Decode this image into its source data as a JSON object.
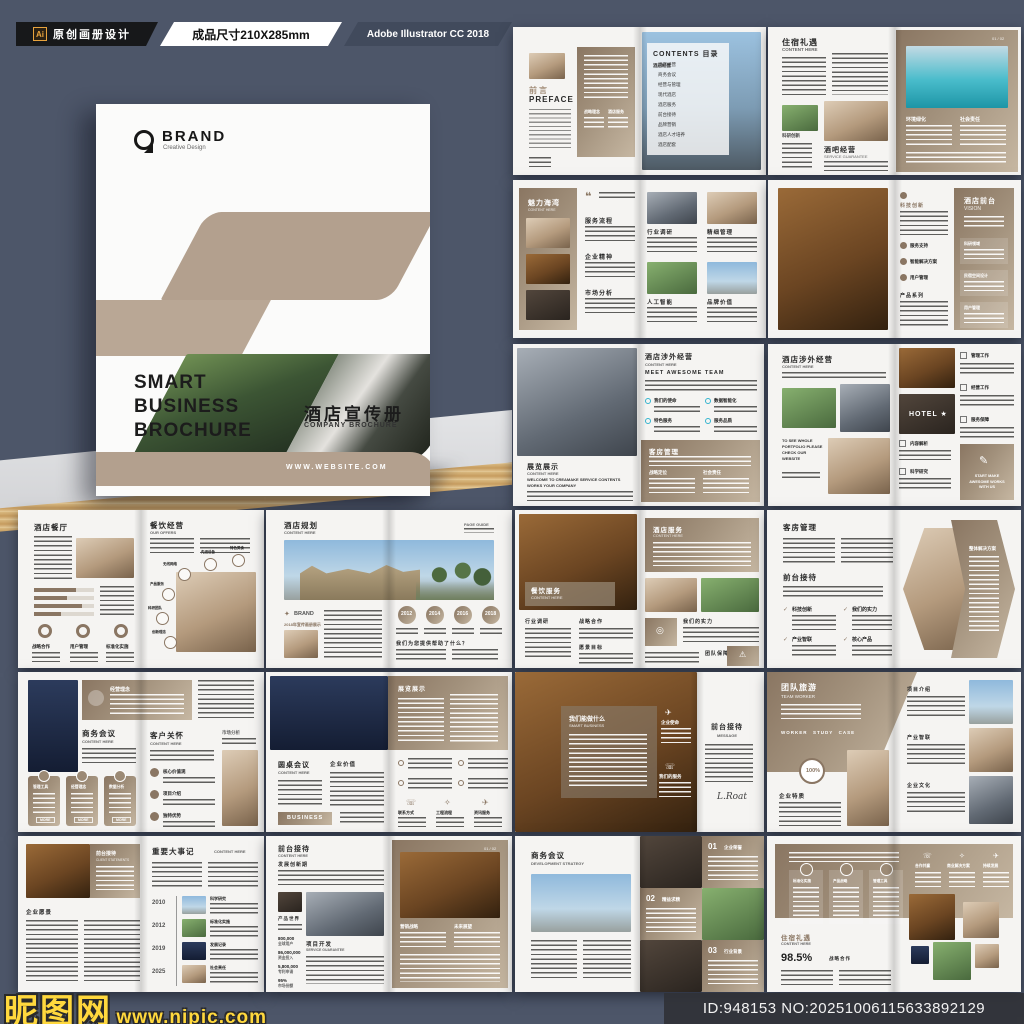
{
  "topbar": {
    "ai": "Ai",
    "badge_label": "原创画册设计",
    "size_label": "成品尺寸210X285mm",
    "software_label": "Adobe Illustrator CC 2018"
  },
  "cover": {
    "brand": "BRAND",
    "brand_sub": "Creative Design",
    "title1": "SMART",
    "title2": "BUSINESS",
    "title3": "BROCHURE",
    "title_cn": "酒店宣传册",
    "title_en": "COMPANY BROCHURE",
    "website": "WWW.WEBSITE.COM"
  },
  "watermark": {
    "site": "昵图网",
    "url": "www.nipic.com"
  },
  "idbar": {
    "text": "ID:948153 NO:20251006115633892129"
  },
  "spreads": {
    "preface": {
      "h_cn": "前言",
      "h_en": "PREFACE",
      "f1": "战略理念",
      "f2": "酒店服务"
    },
    "contents": {
      "title": "CONTENTS 目录",
      "items": [
        "酒店经营",
        "商务会议",
        "经营与管理",
        "现代酒店",
        "酒店服务",
        "前台接待",
        "品牌营销",
        "酒店人才培养",
        "酒店配套"
      ]
    },
    "lodging": {
      "h_cn": "住宿礼遇",
      "h_en": "CONTENT HERE",
      "cap": "科研创新",
      "h2_cn": "酒吧经营",
      "h2_en": "SERVICE GUARANTEE",
      "r1": "环境绿化",
      "r2": "社会责任",
      "pageno": "01 / 02"
    },
    "bay": {
      "h_cn": "魅力海湾",
      "h_en": "CONTENT HERE",
      "a": "服务流程",
      "b": "企业精神",
      "c": "市场分析",
      "q1": "行业调研",
      "q2": "精细管理",
      "q3": "人工智能",
      "q4": "品牌价值"
    },
    "vision": {
      "col1": "科技创新",
      "b1": "服务支持",
      "b2": "智能解决方案",
      "b3": "用户管理",
      "col2": "产品系列",
      "h_cn": "酒店前台",
      "h_en": "VISION",
      "c1": "科研领域",
      "c2": "民宿空间设计",
      "c3": "用户管理"
    },
    "foreign1": {
      "l_cn": "展览展示",
      "l_en": "CONTENT HERE",
      "l_sub": "WELCOME TO CREAMAKE SERVICE CONTENTS WORKS YOUR COMPANY",
      "r_cn": "酒店涉外经营",
      "r_en": "CONTENT HERE",
      "r_sub": "MEET AWESOME TEAM",
      "b1": "我们的使命",
      "b2": "数据智能化",
      "b3": "特色服务",
      "b4": "服务品质",
      "p_cn": "客房管理",
      "p1": "战略定位",
      "p2": "社会责任"
    },
    "foreign2": {
      "h_cn": "酒店涉外经营",
      "h_en": "CONTENT HERE",
      "note": "TO SEE WHOLE PORTFOLIO PLEASE CHECK OUR WEBSITE",
      "hotel": "HOTEL ★",
      "i1": "管理工作",
      "i2": "经营工作",
      "i3": "服务保障",
      "i4": "内容解析",
      "i5": "科学研究",
      "cta": "START MAKE AWESOME WORKS WITH US"
    },
    "restaurant": {
      "h_cn": "酒店餐厅",
      "d1": "战略合作",
      "d2": "用户管理",
      "d3": "标准化实施",
      "r_cn": "餐饮经营",
      "r_en": "OUR OFFERS",
      "o1": "无线网络",
      "o2": "先进设备",
      "o3": "特色美食",
      "o4": "产品服务",
      "o5": "科研团队",
      "o6": "创新理念"
    },
    "planning": {
      "h_cn": "酒店规划",
      "h_en": "CONTENT HERE",
      "corner": "PAGE GUIDE",
      "brand": "BRAND",
      "cap": "2018年宣传画册展示",
      "y1": "2012",
      "y2": "2014",
      "y3": "2016",
      "y4": "2018",
      "q": "我们为您提供帮助了什么？"
    },
    "dining": {
      "l_cn": "餐饮服务",
      "l_en": "CONTENT HERE",
      "c1": "行业调研",
      "c2": "战略合作",
      "c3": "愿景目标",
      "r_cn": "酒店服务",
      "r_en": "CONTENT HERE",
      "r1": "我们的实力",
      "r2": "团队保障"
    },
    "rooms": {
      "h1": "客房管理",
      "h2": "前台接待",
      "k1": "科技创新",
      "k2": "我们的实力",
      "k3": "产业智联",
      "k4": "核心产品",
      "arrow": "整体解决方案"
    },
    "meeting": {
      "banner": "经营理念",
      "l_cn": "商务会议",
      "l_en": "CONTENT HERE",
      "card1": "管理工具",
      "card2": "经营理念",
      "card3": "数据分析",
      "more": "MORE",
      "r_cn": "客户关怀",
      "r_en": "CONTENT HERE",
      "b1": "核心价值观",
      "b2": "项目介绍",
      "b3": "独特优势",
      "corner": "市场分析"
    },
    "roundtable": {
      "panel": "展览展示",
      "l_cn": "圆桌会议",
      "l_en": "CONTENT HERE",
      "col2": "企业价值",
      "btn": "BUSINESS",
      "f1": "联系方式",
      "f2": "工程流程",
      "f3": "资讯服务"
    },
    "smart": {
      "h_cn": "我们能做什么",
      "h_en": "SMART BUSINESS",
      "i1": "企业使命",
      "i2": "我们的服务",
      "r_cn": "前台接待",
      "r_en": "MESSAGE",
      "sig": "L.Roat"
    },
    "team": {
      "h_cn": "团队旅游",
      "h_en": "TEAM WORKER",
      "tags": "WORKER　STUDY　CASE",
      "badge": "100%",
      "h2": "企业特质",
      "r1": "项目介绍",
      "r2": "产业智联",
      "r3": "企业文化"
    },
    "events": {
      "p_cn": "前台接待",
      "p_en": "CLIENT STATEMENTS",
      "h2": "企业愿景",
      "r_cn": "重要大事记",
      "r_en": "CONTENT HERE",
      "y1": "2010",
      "l1": "科学研究",
      "y2": "2012",
      "l2": "标准化实施",
      "y3": "2019",
      "l3": "发展记录",
      "y4": "2025",
      "l4": "社会责任"
    },
    "develop": {
      "h_cn": "前台接待",
      "h_en": "CONTENT HERE",
      "sub": "发展创新期",
      "lab": "产品世界",
      "h2_cn": "项目开发",
      "h2_en": "SERVICE GUARANTEE",
      "s1": "800,000",
      "s1l": "全球用户",
      "s2": "86,000,000",
      "s2l": "资金投入",
      "s3": "5,800,000",
      "s3l": "专利申请",
      "s4": "95%",
      "s4l": "市场份额",
      "r1": "营销战略",
      "r2": "未来展望",
      "pageno": "01 / 02"
    },
    "strategy": {
      "h_cn": "商务会议",
      "h_en": "DEVELOPMENT STRATEGY",
      "n1": "01",
      "n1l": "企业荣誉",
      "n2": "02",
      "n2l": "精益求精",
      "n3": "03",
      "n3l": "行业背景"
    },
    "welfare": {
      "c1": "标准化实施",
      "c2": "产品战略",
      "c3": "管理工具",
      "i1": "合作共赢",
      "i2": "商业解决方案",
      "i3": "持续发展",
      "h_cn": "住宿礼遇",
      "h_en": "CONTENT HERE",
      "stat": "98.5%",
      "statl": "战略合作"
    }
  }
}
